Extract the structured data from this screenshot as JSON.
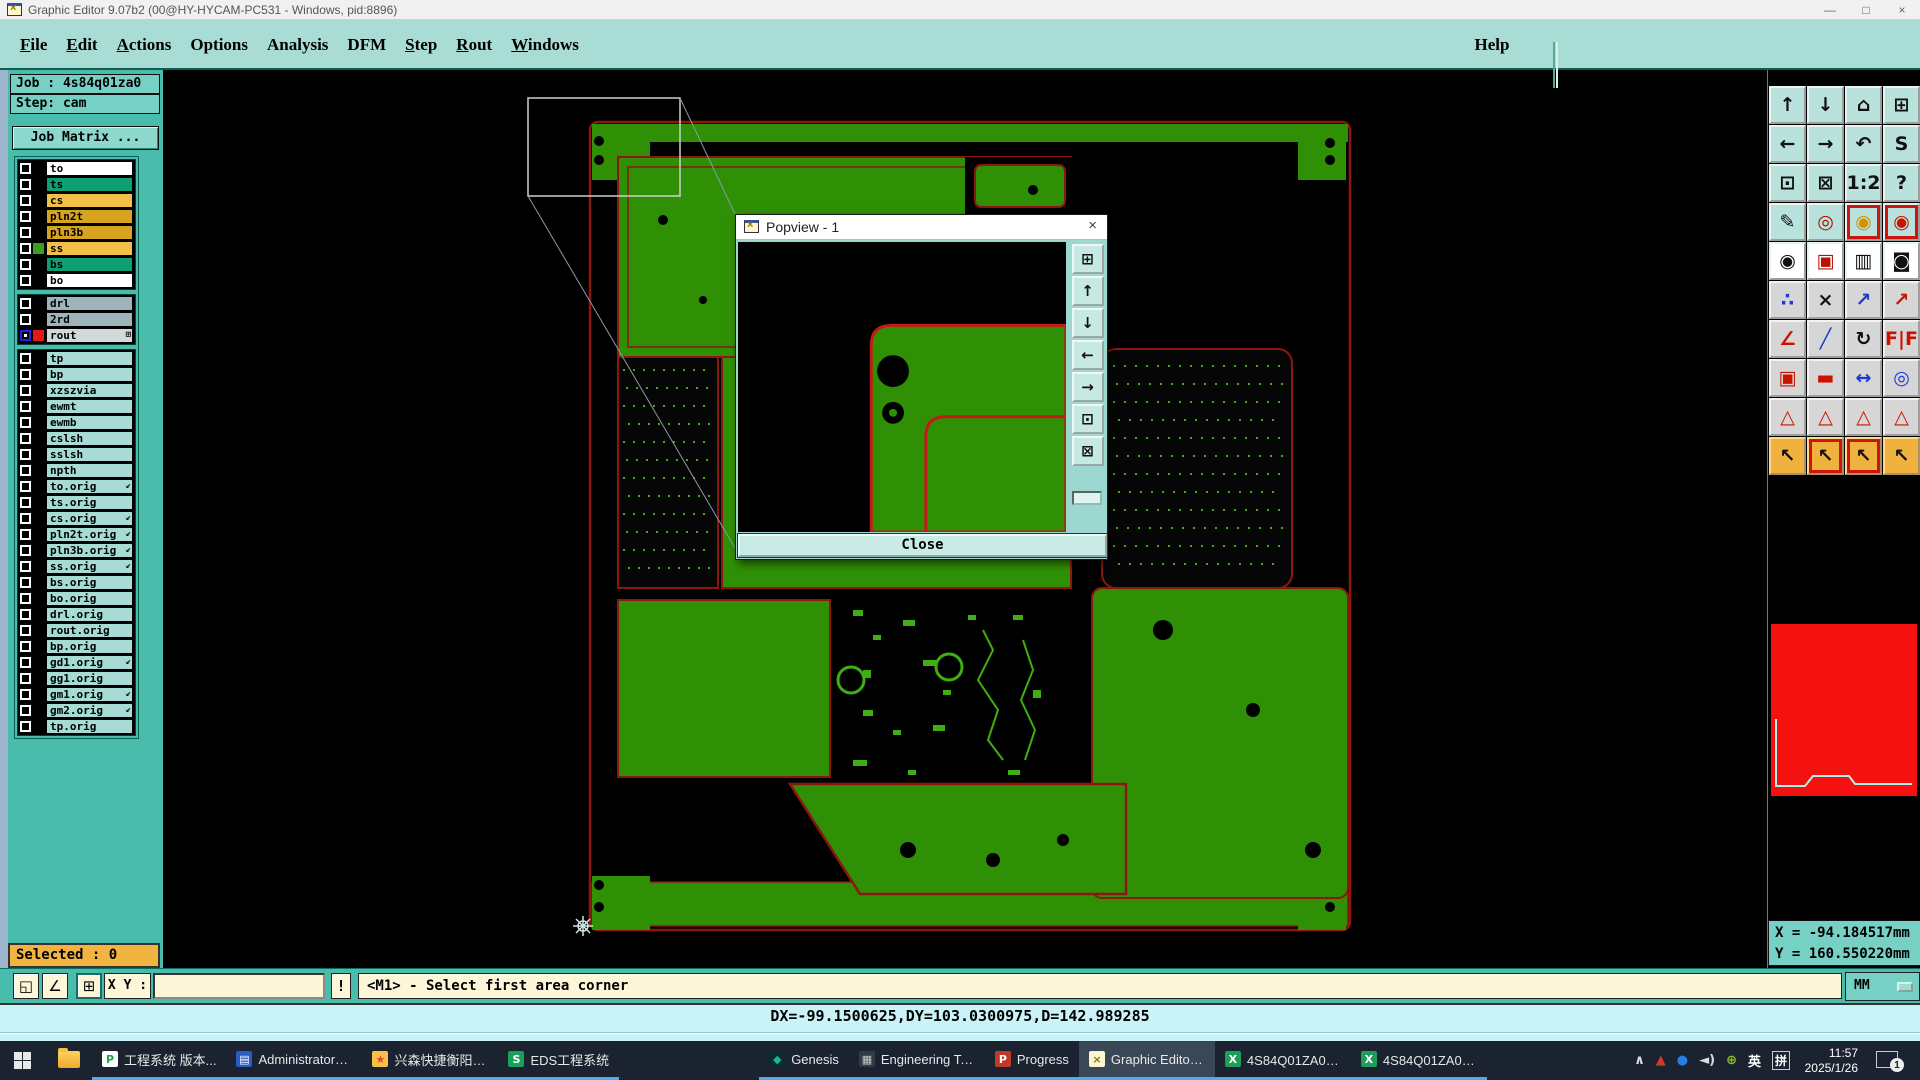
{
  "window": {
    "title": "Graphic Editor 9.07b2 (00@HY-HYCAM-PC531 - Windows, pid:8896)",
    "controls": [
      {
        "name": "minimize-button",
        "glyph": "—"
      },
      {
        "name": "maximize-button",
        "glyph": "□"
      },
      {
        "name": "close-button",
        "glyph": "×"
      }
    ]
  },
  "menu_bar": {
    "items": [
      {
        "name": "menu-file",
        "u": "F",
        "rest": "ile"
      },
      {
        "name": "menu-edit",
        "u": "E",
        "rest": "dit"
      },
      {
        "name": "menu-actions",
        "u": "A",
        "rest": "ctions"
      },
      {
        "name": "menu-options",
        "u": "",
        "rest": "Options"
      },
      {
        "name": "menu-analysis",
        "u": "",
        "rest": "Analysis"
      },
      {
        "name": "menu-dfm",
        "u": "",
        "rest": "DFM"
      },
      {
        "name": "menu-step",
        "u": "S",
        "rest": "tep"
      },
      {
        "name": "menu-rout",
        "u": "R",
        "rest": "out"
      },
      {
        "name": "menu-windows",
        "u": "W",
        "rest": "indows"
      }
    ],
    "help": {
      "label": "Help"
    }
  },
  "brand": {
    "logo_pre": "Fr",
    "logo_o": "o",
    "logo_post": "ntline",
    "product": "Genesis 2000",
    "subtitle": "Graphic Editor",
    "date": "26 Jan 2025",
    "time": "11:45 AM"
  },
  "sidebar": {
    "job_label": "Job : 4s84q01za0",
    "step_label": "Step: cam",
    "job_matrix_button": "Job Matrix ...",
    "selected_label": "Selected : 0",
    "layer_colors": {
      "board_white": "#ffffff",
      "board_teal": "#0e9e74",
      "board_orange": "#f2bf49",
      "board_gold": "#d6a41f",
      "drill_gray": "#9eb4ba",
      "rout_gray": "#d3d8d8",
      "misc_cyan": "#a6dbd6",
      "swatch_green": "#3a9e20",
      "swatch_red": "#ea1515"
    },
    "layer_groups": {
      "board": [
        {
          "name": "to",
          "bg": "#ffffff",
          "swatch": "#000000",
          "cb": "",
          "flag": ""
        },
        {
          "name": "ts",
          "bg": "#0e9e74",
          "swatch": "#000000",
          "cb": "",
          "flag": ""
        },
        {
          "name": "cs",
          "bg": "#f2bf49",
          "swatch": "#000000",
          "cb": "",
          "flag": ""
        },
        {
          "name": "pln2t",
          "bg": "#d6a41f",
          "swatch": "#000000",
          "cb": "",
          "flag": ""
        },
        {
          "name": "pln3b",
          "bg": "#d6a41f",
          "swatch": "#000000",
          "cb": "",
          "flag": ""
        },
        {
          "name": "ss",
          "bg": "#f2bf49",
          "swatch": "#3a9e20",
          "cb": "",
          "flag": ""
        },
        {
          "name": "bs",
          "bg": "#0e9e74",
          "swatch": "#000000",
          "cb": "",
          "flag": ""
        },
        {
          "name": "bo",
          "bg": "#ffffff",
          "swatch": "#000000",
          "cb": "",
          "flag": ""
        }
      ],
      "drill": [
        {
          "name": "drl",
          "bg": "#9eb4ba",
          "swatch": "#000000",
          "cb": "",
          "flag": ""
        },
        {
          "name": "2rd",
          "bg": "#9eb4ba",
          "swatch": "#000000",
          "cb": "",
          "flag": ""
        },
        {
          "name": "rout",
          "bg": "#d3d8d8",
          "swatch": "#ea1515",
          "cb": "wk",
          "flag": "⊞"
        }
      ],
      "misc": [
        {
          "name": "tp",
          "bg": "#a6dbd6",
          "swatch": "#000000",
          "cb": "",
          "flag": ""
        },
        {
          "name": "bp",
          "bg": "#a6dbd6",
          "swatch": "#000000",
          "cb": "",
          "flag": ""
        },
        {
          "name": "xzszvia",
          "bg": "#a6dbd6",
          "swatch": "#000000",
          "cb": "",
          "flag": ""
        },
        {
          "name": "ewmt",
          "bg": "#a6dbd6",
          "swatch": "#000000",
          "cb": "",
          "flag": ""
        },
        {
          "name": "ewmb",
          "bg": "#a6dbd6",
          "swatch": "#000000",
          "cb": "",
          "flag": ""
        },
        {
          "name": "cslsh",
          "bg": "#a6dbd6",
          "swatch": "#000000",
          "cb": "",
          "flag": ""
        },
        {
          "name": "sslsh",
          "bg": "#a6dbd6",
          "swatch": "#000000",
          "cb": "",
          "flag": ""
        },
        {
          "name": "npth",
          "bg": "#a6dbd6",
          "swatch": "#000000",
          "cb": "",
          "flag": ""
        },
        {
          "name": "to.orig",
          "bg": "#a6dbd6",
          "swatch": "#000000",
          "cb": "",
          "flag": "↙"
        },
        {
          "name": "ts.orig",
          "bg": "#a6dbd6",
          "swatch": "#000000",
          "cb": "",
          "flag": ""
        },
        {
          "name": "cs.orig",
          "bg": "#a6dbd6",
          "swatch": "#000000",
          "cb": "",
          "flag": "↙"
        },
        {
          "name": "pln2t.orig",
          "bg": "#a6dbd6",
          "swatch": "#000000",
          "cb": "",
          "flag": "↙"
        },
        {
          "name": "pln3b.orig",
          "bg": "#a6dbd6",
          "swatch": "#000000",
          "cb": "",
          "flag": "↙"
        },
        {
          "name": "ss.orig",
          "bg": "#a6dbd6",
          "swatch": "#000000",
          "cb": "",
          "flag": "↙"
        },
        {
          "name": "bs.orig",
          "bg": "#a6dbd6",
          "swatch": "#000000",
          "cb": "",
          "flag": ""
        },
        {
          "name": "bo.orig",
          "bg": "#a6dbd6",
          "swatch": "#000000",
          "cb": "",
          "flag": ""
        },
        {
          "name": "drl.orig",
          "bg": "#a6dbd6",
          "swatch": "#000000",
          "cb": "",
          "flag": ""
        },
        {
          "name": "rout.orig",
          "bg": "#a6dbd6",
          "swatch": "#000000",
          "cb": "",
          "flag": ""
        },
        {
          "name": "bp.orig",
          "bg": "#a6dbd6",
          "swatch": "#000000",
          "cb": "",
          "flag": ""
        },
        {
          "name": "gd1.orig",
          "bg": "#a6dbd6",
          "swatch": "#000000",
          "cb": "",
          "flag": "↙"
        },
        {
          "name": "gg1.orig",
          "bg": "#a6dbd6",
          "swatch": "#000000",
          "cb": "",
          "flag": ""
        },
        {
          "name": "gm1.orig",
          "bg": "#a6dbd6",
          "swatch": "#000000",
          "cb": "",
          "flag": "↙"
        },
        {
          "name": "gm2.orig",
          "bg": "#a6dbd6",
          "swatch": "#000000",
          "cb": "",
          "flag": "↙"
        },
        {
          "name": "tp.orig",
          "bg": "#a6dbd6",
          "swatch": "#000000",
          "cb": "",
          "flag": ""
        }
      ]
    }
  },
  "popview": {
    "title": "Popview - 1",
    "close_x": "×",
    "close_button": "Close",
    "toolbar": [
      {
        "name": "popview-clone-icon",
        "glyph": "⊞"
      },
      {
        "name": "popview-pan-up-icon",
        "glyph": "↑"
      },
      {
        "name": "popview-pan-down-icon",
        "glyph": "↓"
      },
      {
        "name": "popview-pan-left-icon",
        "glyph": "←"
      },
      {
        "name": "popview-pan-right-icon",
        "glyph": "→"
      },
      {
        "name": "popview-zoom-in-icon",
        "glyph": "⊡"
      },
      {
        "name": "popview-zoom-out-icon",
        "glyph": "⊠"
      }
    ]
  },
  "right_toolbar": {
    "buttons": [
      {
        "name": "pan-view-up-icon",
        "glyph": "↑",
        "cls": "teal",
        "fg": "#111111"
      },
      {
        "name": "pan-view-down-icon",
        "glyph": "↓",
        "cls": "teal",
        "fg": "#111111"
      },
      {
        "name": "home-view-icon",
        "glyph": "⌂",
        "cls": "teal",
        "fg": "#111111"
      },
      {
        "name": "split-view-xy-icon",
        "glyph": "⊞",
        "cls": "teal",
        "fg": "#111111"
      },
      {
        "name": "pan-view-left-icon",
        "glyph": "←",
        "cls": "teal",
        "fg": "#111111"
      },
      {
        "name": "pan-view-right-icon",
        "glyph": "→",
        "cls": "teal",
        "fg": "#111111"
      },
      {
        "name": "zoom-previous-icon",
        "glyph": "↶",
        "cls": "teal",
        "fg": "#111111"
      },
      {
        "name": "zoom-path-icon",
        "glyph": "S",
        "cls": "teal",
        "fg": "#111111"
      },
      {
        "name": "zoom-in-area-icon",
        "glyph": "⊡",
        "cls": "teal",
        "fg": "#111111"
      },
      {
        "name": "zoom-out-icon",
        "glyph": "⊠",
        "cls": "teal",
        "fg": "#111111"
      },
      {
        "name": "zoom-ratio-1-2-icon",
        "glyph": "1:2",
        "cls": "teal",
        "fg": "#111111"
      },
      {
        "name": "query-feature-icon",
        "glyph": "?",
        "cls": "teal",
        "fg": "#111111"
      },
      {
        "name": "setup-tools-icon",
        "glyph": "✎",
        "cls": "teal",
        "fg": "#111111"
      },
      {
        "name": "grid-snap-icon",
        "glyph": "◎",
        "cls": "teal",
        "fg": "#aa1100"
      },
      {
        "name": "signal-layers-a-icon",
        "glyph": "◉",
        "cls": "teal framed-red",
        "fg": "#d88f00"
      },
      {
        "name": "signal-layers-b-icon",
        "glyph": "◉",
        "cls": "teal framed-red",
        "fg": "#cc1100"
      },
      {
        "name": "select-round-feature-icon",
        "glyph": "◉",
        "cls": "light",
        "fg": "#111111"
      },
      {
        "name": "transform-box-icon",
        "glyph": "▣",
        "cls": "light",
        "fg": "#bb1100"
      },
      {
        "name": "measure-ruler-icon",
        "glyph": "▥",
        "cls": "light",
        "fg": "#111111"
      },
      {
        "name": "capture-pad-icon",
        "glyph": "◙",
        "cls": "light",
        "fg": "#111111"
      },
      {
        "name": "net-points-icon",
        "glyph": "∴",
        "cls": "gray",
        "fg": "#1a3ad0"
      },
      {
        "name": "delete-feature-icon",
        "glyph": "×",
        "cls": "gray",
        "fg": "#111111"
      },
      {
        "name": "copy-circle-icon",
        "glyph": "↗",
        "cls": "gray",
        "fg": "#1a3ad0"
      },
      {
        "name": "copy-pad-icon",
        "glyph": "↗",
        "cls": "gray",
        "fg": "#cc1100"
      },
      {
        "name": "measure-angle-icon",
        "glyph": "∠",
        "cls": "gray",
        "fg": "#cc1100"
      },
      {
        "name": "draw-line-icon",
        "glyph": "╱",
        "cls": "gray",
        "fg": "#1a3ad0"
      },
      {
        "name": "rotate-feature-icon",
        "glyph": "↻",
        "cls": "gray",
        "fg": "#111111"
      },
      {
        "name": "mirror-feature-icon",
        "glyph": "F|F",
        "cls": "gray",
        "fg": "#cc1100"
      },
      {
        "name": "swap-pads-icon",
        "glyph": "▣",
        "cls": "gray",
        "fg": "#cc1100"
      },
      {
        "name": "stretch-pad-icon",
        "glyph": "▬",
        "cls": "gray",
        "fg": "#cc1100"
      },
      {
        "name": "measure-distance-icon",
        "glyph": "↔",
        "cls": "gray",
        "fg": "#1a3ad0"
      },
      {
        "name": "merge-shapes-icon",
        "glyph": "◎",
        "cls": "gray",
        "fg": "#1a3ad0"
      },
      {
        "name": "arc-corner-a-icon",
        "glyph": "△",
        "cls": "gray",
        "fg": "#cc1100"
      },
      {
        "name": "arc-corner-b-icon",
        "glyph": "△",
        "cls": "gray",
        "fg": "#cc1100"
      },
      {
        "name": "arc-corner-c-icon",
        "glyph": "△",
        "cls": "gray",
        "fg": "#cc1100"
      },
      {
        "name": "arc-corner-d-icon",
        "glyph": "△",
        "cls": "gray",
        "fg": "#cc1100"
      },
      {
        "name": "select-pointer-icon",
        "glyph": "↖",
        "cls": "amber",
        "fg": "#111111"
      },
      {
        "name": "select-frame-icon",
        "glyph": "↖",
        "cls": "amber framed-red",
        "fg": "#111111"
      },
      {
        "name": "select-polygon-icon",
        "glyph": "↖",
        "cls": "amber framed-red",
        "fg": "#111111"
      },
      {
        "name": "select-path-icon",
        "glyph": "↖",
        "cls": "amber",
        "fg": "#111111"
      }
    ]
  },
  "coords": {
    "x": "X = -94.184517mm",
    "y": "Y = 160.550220mm",
    "units": "MM"
  },
  "command_bar": {
    "buttons": [
      {
        "name": "zoom-area-mode-button",
        "glyph": "◱"
      },
      {
        "name": "measure-mode-button",
        "glyph": "∠"
      },
      {
        "name": "tile-views-button",
        "glyph": "⊞"
      }
    ],
    "xy_label": "X Y :",
    "input_value": "",
    "bang": "!",
    "status": "<M1> - Select first area corner"
  },
  "delta_bar": {
    "text": "DX=-99.1500625,DY=103.0300975,D=142.989285"
  },
  "taskbar": {
    "apps": [
      {
        "name": "taskbar-item-gongcheng",
        "label": "工程系统  版本...",
        "cls": "",
        "icon": {
          "ch": "P",
          "fg": "#1fa54c",
          "bg": "#ffffff"
        }
      },
      {
        "name": "taskbar-item-administrator",
        "label": "Administrator^ ...",
        "cls": "",
        "icon": {
          "ch": "▤",
          "fg": "#ffffff",
          "bg": "#2a59c8"
        }
      },
      {
        "name": "taskbar-item-xingsen",
        "label": "兴森快捷衡阳分...",
        "cls": "",
        "icon": {
          "ch": "★",
          "fg": "#e04b2f",
          "bg": "#f6c04a"
        }
      },
      {
        "name": "taskbar-item-eds",
        "label": "EDS工程系统",
        "cls": "",
        "icon": {
          "ch": "S",
          "fg": "#ffffff",
          "bg": "#15a35c"
        }
      },
      {
        "name": "taskbar-item-genesis",
        "label": "Genesis",
        "cls": "gap-left",
        "icon": {
          "ch": "◆",
          "fg": "#17b79a",
          "bg": "#0d2b2b"
        }
      },
      {
        "name": "taskbar-item-engineering",
        "label": "Engineering To...",
        "cls": "",
        "icon": {
          "ch": "▦",
          "fg": "#cccccc",
          "bg": "#323a46"
        }
      },
      {
        "name": "taskbar-item-progress",
        "label": "Progress",
        "cls": "",
        "icon": {
          "ch": "P",
          "fg": "#ffffff",
          "bg": "#c03a2a"
        }
      },
      {
        "name": "taskbar-item-graphic-editor",
        "label": "Graphic Editor ...",
        "cls": "active",
        "icon": {
          "ch": "×",
          "fg": "#8a7a10",
          "bg": "#fdf7cf"
        }
      },
      {
        "name": "taskbar-item-4s84-zhi",
        "label": "4S84Q01ZA0制...",
        "cls": "",
        "icon": {
          "ch": "X",
          "fg": "#ffffff",
          "bg": "#1f9e5b"
        }
      },
      {
        "name": "taskbar-item-4s84-yu",
        "label": "4S84Q01ZA0预...",
        "cls": "",
        "icon": {
          "ch": "X",
          "fg": "#ffffff",
          "bg": "#1f9e5b"
        }
      }
    ],
    "tray": [
      {
        "name": "tray-chevron-icon",
        "glyph": "∧",
        "fg": "#dddddd",
        "cls": ""
      },
      {
        "name": "tray-graph-icon",
        "glyph": "▲",
        "fg": "#d23b2a",
        "cls": ""
      },
      {
        "name": "tray-browser-icon",
        "glyph": "●",
        "fg": "#2a7de1",
        "cls": ""
      },
      {
        "name": "tray-volume-icon",
        "glyph": "◄)",
        "fg": "#dddddd",
        "cls": ""
      },
      {
        "name": "tray-update-icon",
        "glyph": "⊕",
        "fg": "#8fc31f",
        "cls": ""
      },
      {
        "name": "tray-ime-lang",
        "glyph": "英",
        "fg": "#ffffff",
        "cls": ""
      },
      {
        "name": "tray-ime-pin",
        "glyph": "拼",
        "fg": "#ffffff",
        "cls": "boxed"
      }
    ],
    "clock": {
      "time": "11:57",
      "date": "2025/1/26"
    },
    "notification_badge": "1"
  }
}
